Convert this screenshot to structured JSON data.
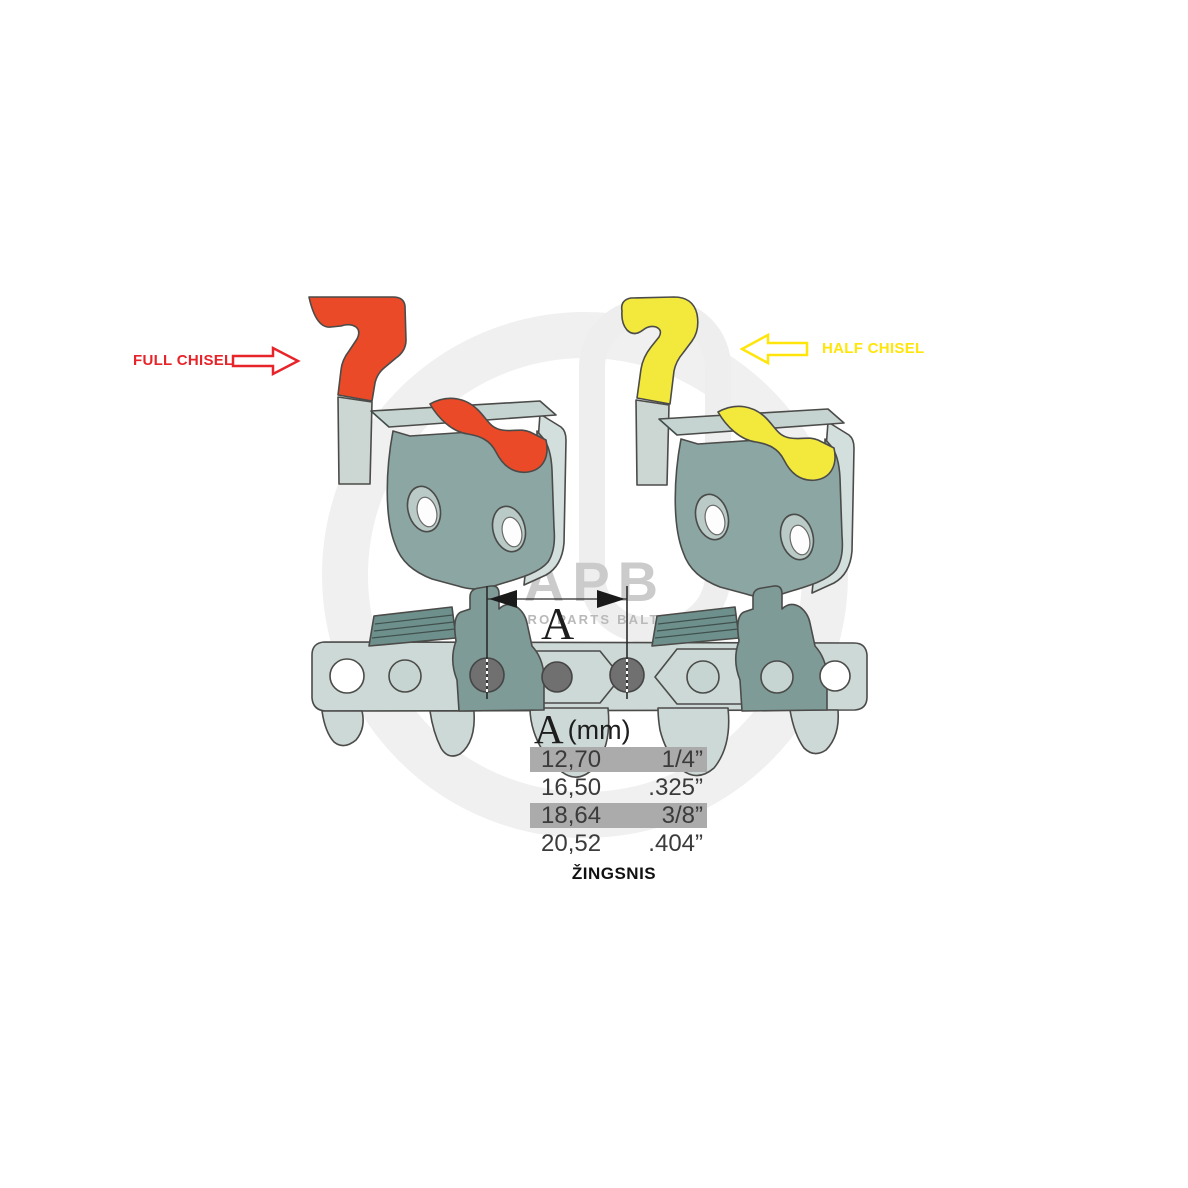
{
  "labels": {
    "full_chisel": "FULL CHISEL",
    "half_chisel": "HALF CHISEL",
    "pitch_caption": "ŽINGSNIS"
  },
  "dimension": {
    "letter": "A"
  },
  "pitch_table": {
    "header_letter": "A",
    "header_unit": "(mm)",
    "rows": [
      {
        "mm": "12,70",
        "inch": "1/4”",
        "highlighted": true
      },
      {
        "mm": "16,50",
        "inch": ".325”",
        "highlighted": false
      },
      {
        "mm": "18,64",
        "inch": "3/8”",
        "highlighted": true
      },
      {
        "mm": "20,52",
        "inch": ".404”",
        "highlighted": false
      }
    ]
  },
  "watermark": {
    "logo": "APB",
    "tagline": "AGRO PARTS BALTIJA"
  },
  "colors": {
    "full_chisel_red": "#e8242b",
    "half_chisel_yellow": "#ffe50a",
    "highlight_red": "#ea4a28",
    "highlight_yellow": "#f3e93c",
    "steel_teal": "#8ca7a3",
    "steel_light": "#cdd9d6",
    "row_highlight_gray": "#ababab"
  }
}
